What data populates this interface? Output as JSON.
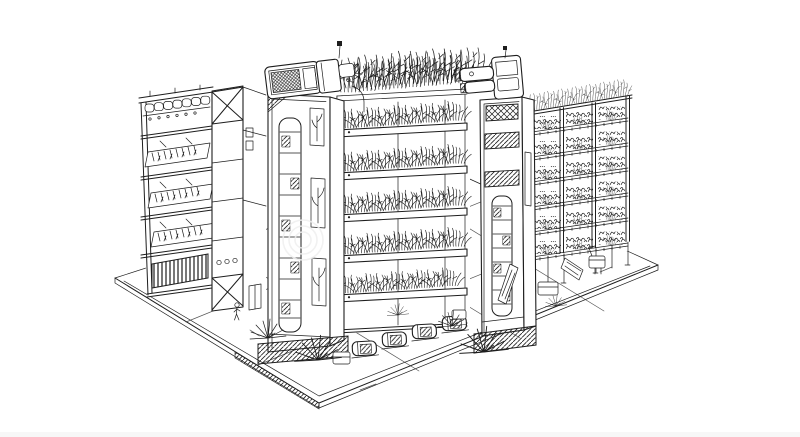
{
  "canvas": {
    "width": 800,
    "height": 437
  },
  "meta": {
    "kind": "ink line-art illustration",
    "background_color": "#ffffff",
    "ink_color": "#1e1e1e",
    "watermark_color": "#efefef",
    "bottom_strip_color": "#f7f7f7"
  },
  "scene": {
    "aria_label": "Black-and-white ink sketch of a futuristic vertical farm complex: a multi-storey open shelving block with seedling trays, two service towers topped with rooftop machinery and antennas, a central building with cantilevered shelves overflowing with leafy crops, a tall rack tower of planting trays, harvest carts, bins and spiky shrubs on an isometric paved plaza, with a tiny human figure for scale.",
    "elements": [
      {
        "name": "ground-plaza",
        "desc": "isometric paved plaza slab with joint lines and hatched curb"
      },
      {
        "name": "left-shelf-building",
        "desc": "open multi-level block with tilted seedling trays, pod row, slatted vent grille, porthole windows, cross-braced corner column and service door"
      },
      {
        "name": "left-elevator-tower",
        "desc": "service tower with ladder window, planted window panels and hatched plinth"
      },
      {
        "name": "rooftop-machine-left",
        "desc": "boxy climate unit with cross-hatched grille, motor cylinder, antenna and irrigation pipe"
      },
      {
        "name": "grow-shelf-building",
        "desc": "five cantilevered grow shelves densely planted with leafy crops plus rooftop canopy"
      },
      {
        "name": "right-elevator-tower",
        "desc": "second service tower with lattice window, hatched vent bands, ladder window and leaning panel"
      },
      {
        "name": "rooftop-machine-right",
        "desc": "cylindrical motor unit with stacked barrels, mount and antenna"
      },
      {
        "name": "right-rack-building",
        "desc": "six-tier rack tower of planting trays with rooftop shrubs, legs, chute and service robot"
      },
      {
        "name": "harvest-carts",
        "desc": "row of rounded harvest carts and bins parked under the shelves"
      },
      {
        "name": "ground-plants",
        "desc": "spiky shrubs at the building bases"
      },
      {
        "name": "pedestrian-figure",
        "desc": "tiny person standing on the plaza"
      },
      {
        "name": "watermark-swirl",
        "desc": "faint concentric watermark circles"
      }
    ]
  }
}
